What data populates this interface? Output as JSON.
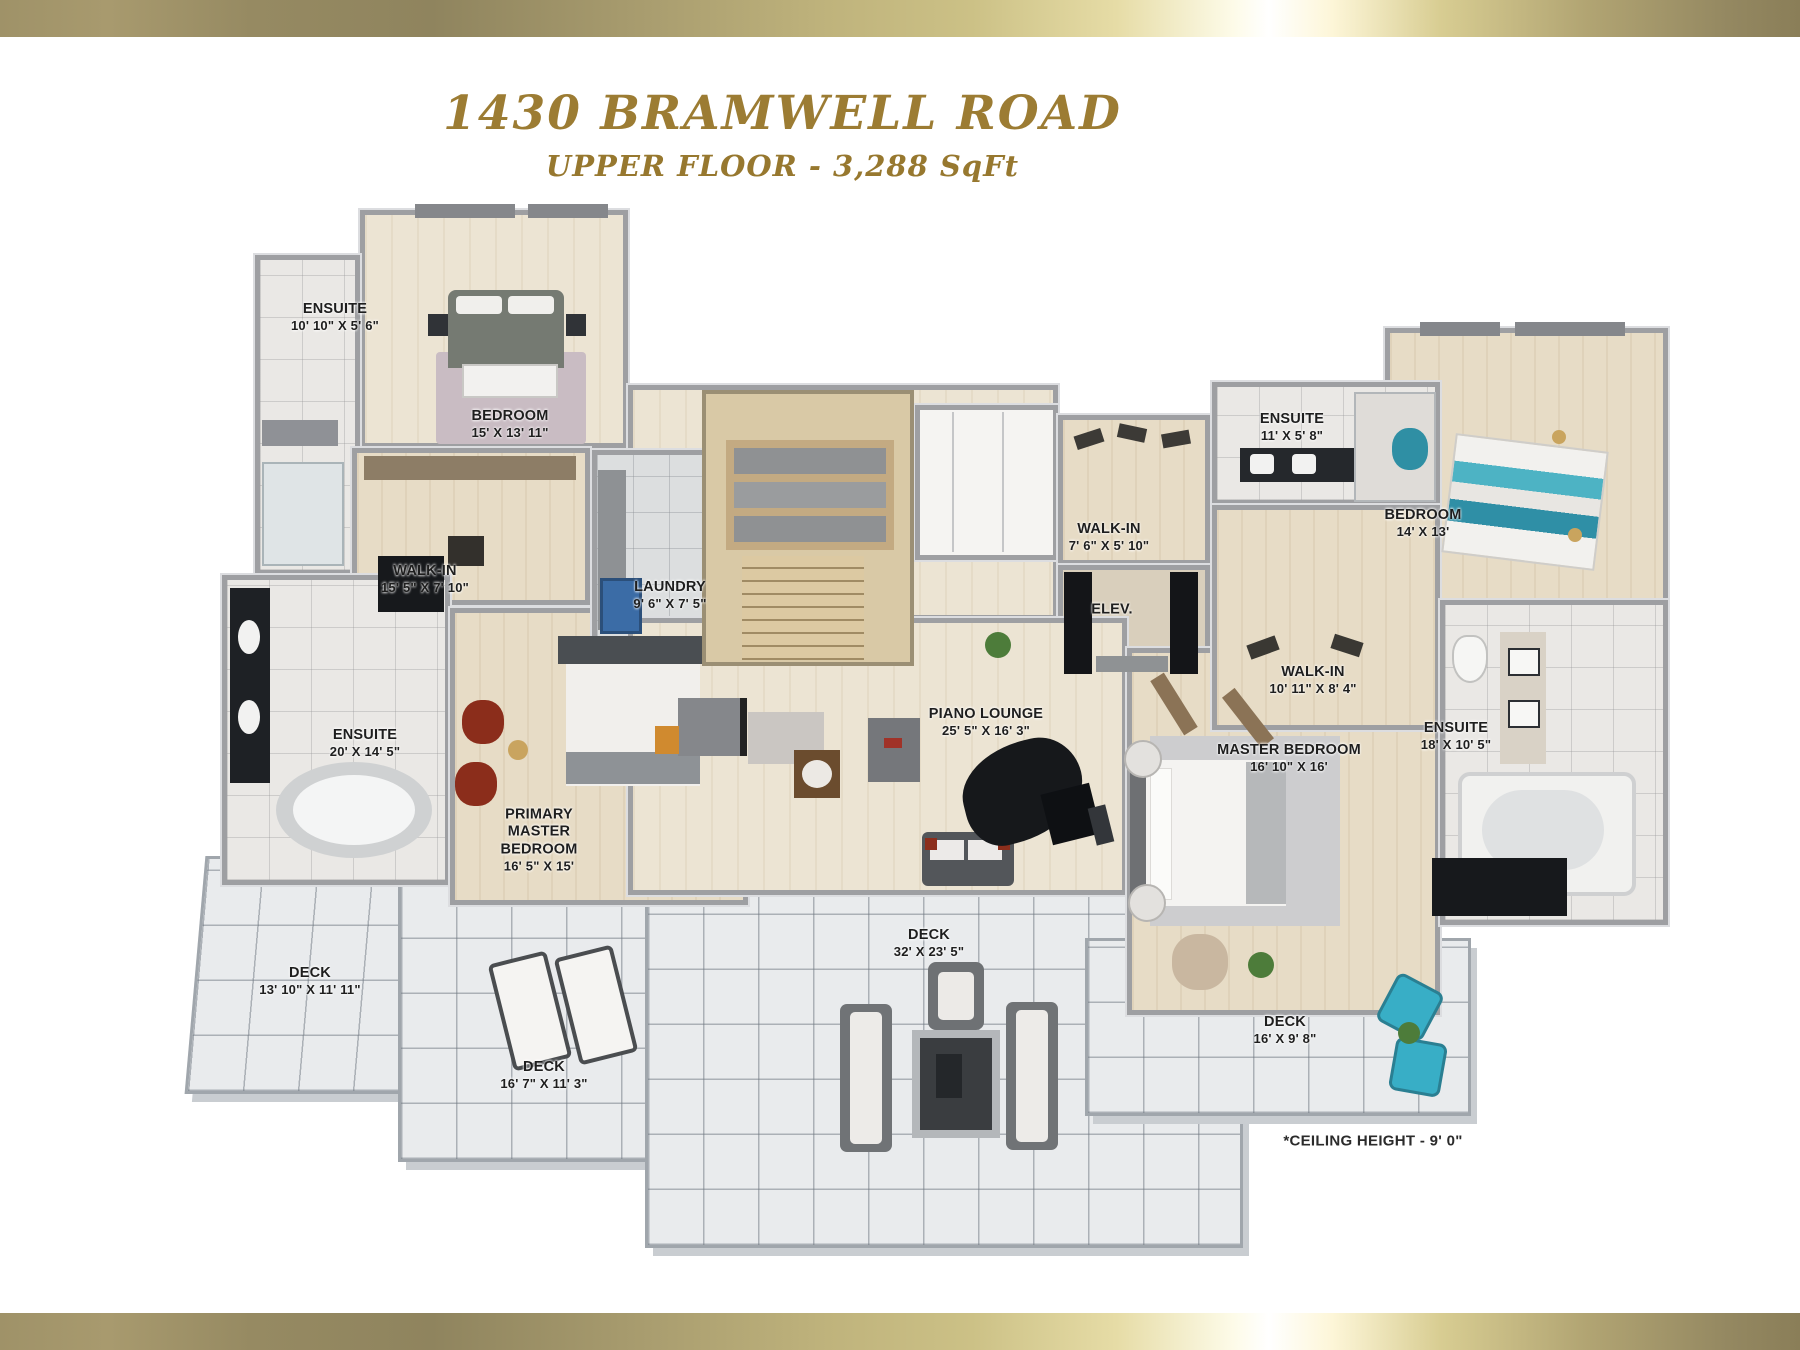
{
  "header": {
    "title": "1430 BRAMWELL ROAD",
    "subtitle": "UPPER FLOOR - 3,288 SqFt"
  },
  "rooms": [
    {
      "id": "ensuite-1",
      "name": "ENSUITE",
      "dims": "10' 10\" X 5' 6\""
    },
    {
      "id": "bedroom-1",
      "name": "BEDROOM",
      "dims": "15' X 13' 11\""
    },
    {
      "id": "walk-in-1",
      "name": "WALK-IN",
      "dims": "15' 5\" X 7' 10\""
    },
    {
      "id": "laundry",
      "name": "LAUNDRY",
      "dims": "9' 6\" X 7' 5\""
    },
    {
      "id": "ensuite-2",
      "name": "ENSUITE",
      "dims": "20' X 14' 5\""
    },
    {
      "id": "primary-master-bedroom",
      "name": "PRIMARY\nMASTER BEDROOM",
      "dims": "16' 5\" X 15'"
    },
    {
      "id": "walk-in-2",
      "name": "WALK-IN",
      "dims": "7' 6\" X 5' 10\""
    },
    {
      "id": "elevator",
      "name": "ELEV.",
      "dims": ""
    },
    {
      "id": "piano-lounge",
      "name": "PIANO LOUNGE",
      "dims": "25' 5\" X 16' 3\""
    },
    {
      "id": "ensuite-3",
      "name": "ENSUITE",
      "dims": "11' X 5' 8\""
    },
    {
      "id": "bedroom-2",
      "name": "BEDROOM",
      "dims": "14' X 13'"
    },
    {
      "id": "walk-in-3",
      "name": "WALK-IN",
      "dims": "10' 11\" X 8' 4\""
    },
    {
      "id": "master-bedroom",
      "name": "MASTER BEDROOM",
      "dims": "16' 10\" X 16'"
    },
    {
      "id": "ensuite-4",
      "name": "ENSUITE",
      "dims": "18' X 10' 5\""
    },
    {
      "id": "deck-1",
      "name": "DECK",
      "dims": "13' 10\" X 11' 11\""
    },
    {
      "id": "deck-2",
      "name": "DECK",
      "dims": "16' 7\" X 11' 3\""
    },
    {
      "id": "deck-3",
      "name": "DECK",
      "dims": "32' X 23' 5\""
    },
    {
      "id": "deck-4",
      "name": "DECK",
      "dims": "16' X 9' 8\""
    }
  ],
  "note": "*CEILING HEIGHT - 9' 0\"",
  "colors": {
    "gold": "#9c7c33",
    "wall_gray": "#9e9fa2",
    "wood_floor": "#e7dcc6",
    "tile_floor": "#eae8e5",
    "deck_floor": "#e9ebed",
    "accent_teal": "#38aec6",
    "accent_red": "#8c2e1c"
  }
}
